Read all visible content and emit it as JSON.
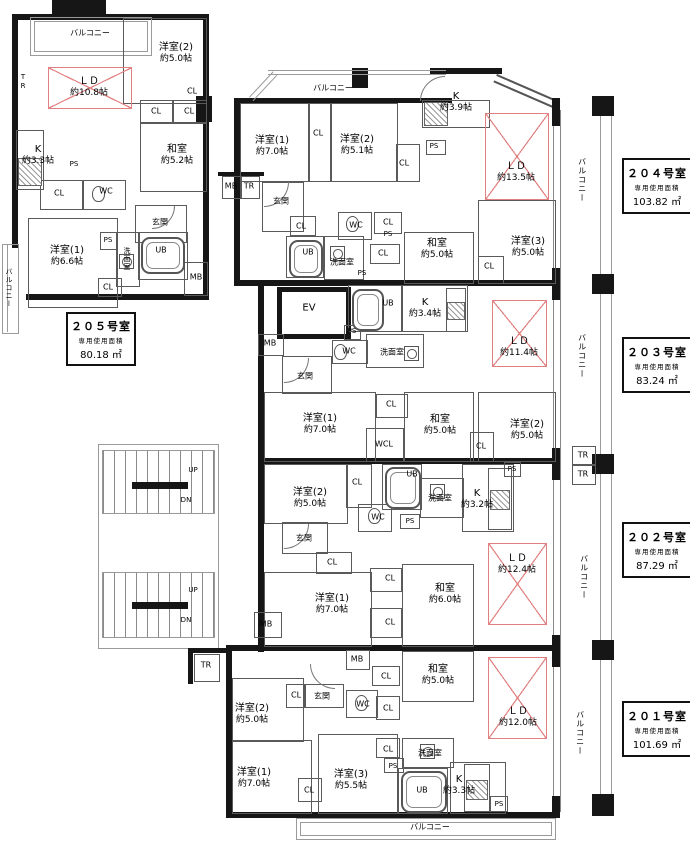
{
  "a": {
    "cl": "CL",
    "wc": "WC",
    "ub": "UB",
    "ps": "PS",
    "mb": "MB",
    "tr": "TR",
    "wcl": "WCL",
    "ev": "EV",
    "up": "UP",
    "dn": "DN",
    "genkan": "玄関",
    "senmen": "洗面室",
    "balcony": "バルコニー",
    "washitsu": "和室",
    "yo1": "洋室(1)",
    "yo2": "洋室(2)",
    "yo3": "洋室(3)",
    "k": "K",
    "ld": "ＬＤ"
  },
  "u205": {
    "name": "２０５号室",
    "cap": "専用使用面積",
    "area": "80.18 ㎡",
    "ld_s": "約10.8帖",
    "k_s": "約3.3帖",
    "yo1_s": "約6.6帖",
    "yo2_s": "約5.0帖",
    "wa_s": "約5.2帖"
  },
  "u204": {
    "name": "２０４号室",
    "cap": "専用使用面積",
    "area": "103.82 ㎡",
    "ld_s": "約13.5帖",
    "k_s": "約3.9帖",
    "yo1_s": "約7.0帖",
    "yo2_s": "約5.1帖",
    "yo3_s": "約5.0帖",
    "wa_s": "約5.0帖"
  },
  "u203": {
    "name": "２０３号室",
    "cap": "専用使用面積",
    "area": "83.24 ㎡",
    "ld_s": "約11.4帖",
    "k_s": "約3.4帖",
    "yo1_s": "約7.0帖",
    "yo2_s": "約5.0帖",
    "wa_s": "約5.0帖"
  },
  "u202": {
    "name": "２０２号室",
    "cap": "専用使用面積",
    "area": "87.29 ㎡",
    "ld_s": "約12.4帖",
    "k_s": "約3.2帖",
    "yo1_s": "約7.0帖",
    "yo2_s": "約5.0帖",
    "wa_s": "約6.0帖"
  },
  "u201": {
    "name": "２０１号室",
    "cap": "専用使用面積",
    "area": "101.69 ㎡",
    "ld_s": "約12.0帖",
    "k_s": "約3.3帖",
    "yo1_s": "約7.0帖",
    "yo2_s": "約5.0帖",
    "yo3_s": "約5.5帖",
    "wa_s": "約5.0帖"
  }
}
